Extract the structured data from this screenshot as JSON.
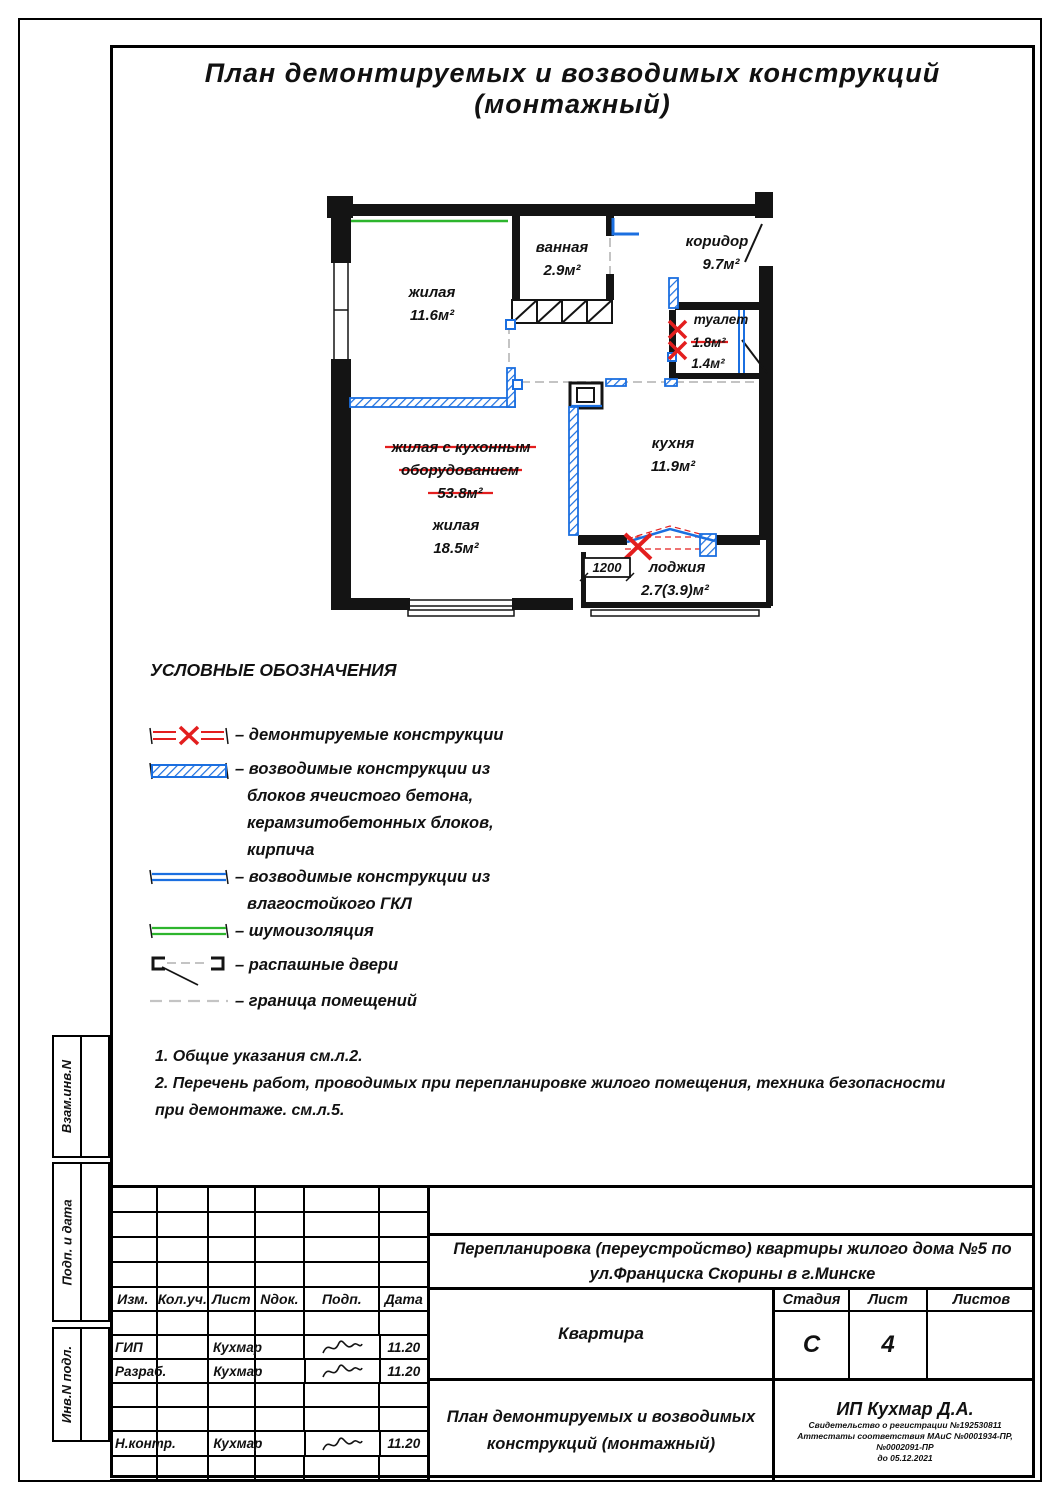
{
  "title": "План  демонтируемых  и  возводимых  конструкций  (монтажный)",
  "plan": {
    "living1": {
      "name": "жилая",
      "area": "11.6м²"
    },
    "bath": {
      "name": "ванная",
      "area": "2.9м²"
    },
    "corridor": {
      "name": "коридор",
      "area": "9.7м²"
    },
    "wc": {
      "name": "туалет",
      "area_old": "1.8м²",
      "area_new": "1.4м²"
    },
    "struck_room": {
      "l1": "жилая с кухонным",
      "l2": "оборудованием",
      "area": "53.8м²"
    },
    "living2": {
      "name": "жилая",
      "area": "18.5м²"
    },
    "kitchen": {
      "name": "кухня",
      "area": "11.9м²"
    },
    "loggia": {
      "name": "лоджия",
      "area": "2.7(3.9)м²"
    },
    "dim": "1200"
  },
  "legend": {
    "heading": "УСЛОВНЫЕ ОБОЗНАЧЕНИЯ",
    "item1": {
      "t": "– демонтируемые конструкции"
    },
    "item2": {
      "l1": "– возводимые конструкции из",
      "l2": "блоков ячеистого бетона,",
      "l3": "керамзитобетонных блоков,",
      "l4": "кирпича"
    },
    "item3": {
      "l1": "– возводимые конструкции из",
      "l2": "влагостойкого ГКЛ"
    },
    "item4": {
      "t": "– шумоизоляция"
    },
    "item5": {
      "t": "– распашные двери"
    },
    "item6": {
      "t": "– граница помещений"
    }
  },
  "notes": {
    "n1": "1. Общие указания см.л.2.",
    "n2": "2. Перечень работ, проводимых при перепланировке жилого помещения, техника безопасности",
    "n3": "при демонтаже. см.л.5."
  },
  "side": {
    "s1": "Взам.инв.N",
    "s2": "Подп. и дата",
    "s3": "Инв.N подл."
  },
  "tb": {
    "cols": [
      "Изм.",
      "Кол.уч.",
      "Лист",
      "Nдок.",
      "Подп.",
      "Дата"
    ],
    "staff": [
      {
        "role": "ГИП",
        "name": "Кухмар",
        "date": "11.20"
      },
      {
        "role": "Разраб.",
        "name": "Кухмар",
        "date": "11.20"
      },
      {
        "role": "Н.контр.",
        "name": "Кухмар",
        "date": "11.20"
      }
    ],
    "project_l1": "Перепланировка (переустройство) квартиры  жилого дома №5 по",
    "project_l2": "ул.Франциска Скорины в г.Минске",
    "object": "Квартира",
    "drawing_l1": "План демонтируемых и возводимых",
    "drawing_l2": "конструкций (монтажный)",
    "stage_label": "Стадия",
    "stage": "С",
    "sheet_label": "Лист",
    "sheet": "4",
    "sheets_label": "Листов",
    "sheets": "",
    "firm_name": "ИП Кухмар Д.А.",
    "cert1": "Свидетельство о регистрации №192530811",
    "cert2": "Аттестаты соответствия МАиС №0001934-ПР, №0002091-ПР",
    "cert3": "до 05.12.2021"
  },
  "colors": {
    "new_construction": "#1b6fe0",
    "demolition": "#e31e1e",
    "sound_insulation": "#2db52d"
  }
}
